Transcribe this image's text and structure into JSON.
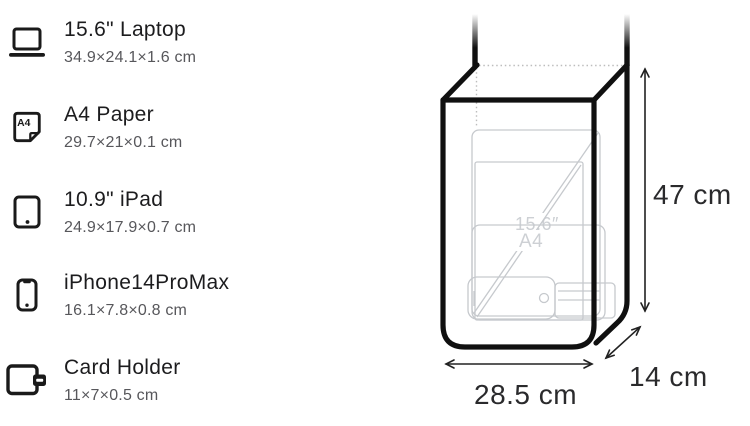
{
  "item_list": {
    "items": [
      {
        "name": "15.6\" Laptop",
        "dims": "34.9×24.1×1.6 cm",
        "icon": "laptop-icon"
      },
      {
        "name": "A4 Paper",
        "dims": "29.7×21×0.1 cm",
        "icon": "a4-paper-icon",
        "icon_text": "A4"
      },
      {
        "name": "10.9\" iPad",
        "dims": "24.9×17.9×0.7 cm",
        "icon": "ipad-icon"
      },
      {
        "name": "iPhone14ProMax",
        "dims": "16.1×7.8×0.8 cm",
        "icon": "iphone-icon"
      },
      {
        "name": "Card Holder",
        "dims": "11×7×0.5 cm",
        "icon": "card-holder-icon"
      }
    ]
  },
  "diagram": {
    "height_label": "47 cm",
    "width_label": "28.5 cm",
    "depth_label": "14 cm",
    "ghost_items": {
      "laptop_label": "15.6″",
      "paper_label": "A4"
    }
  },
  "colors": {
    "text_primary": "#1c1c1e",
    "text_secondary": "#57575b",
    "bag_outline": "#101010",
    "ghost_outline": "#c6c9cd",
    "dotted_line": "#bdbdbd",
    "arrow": "#222222"
  }
}
